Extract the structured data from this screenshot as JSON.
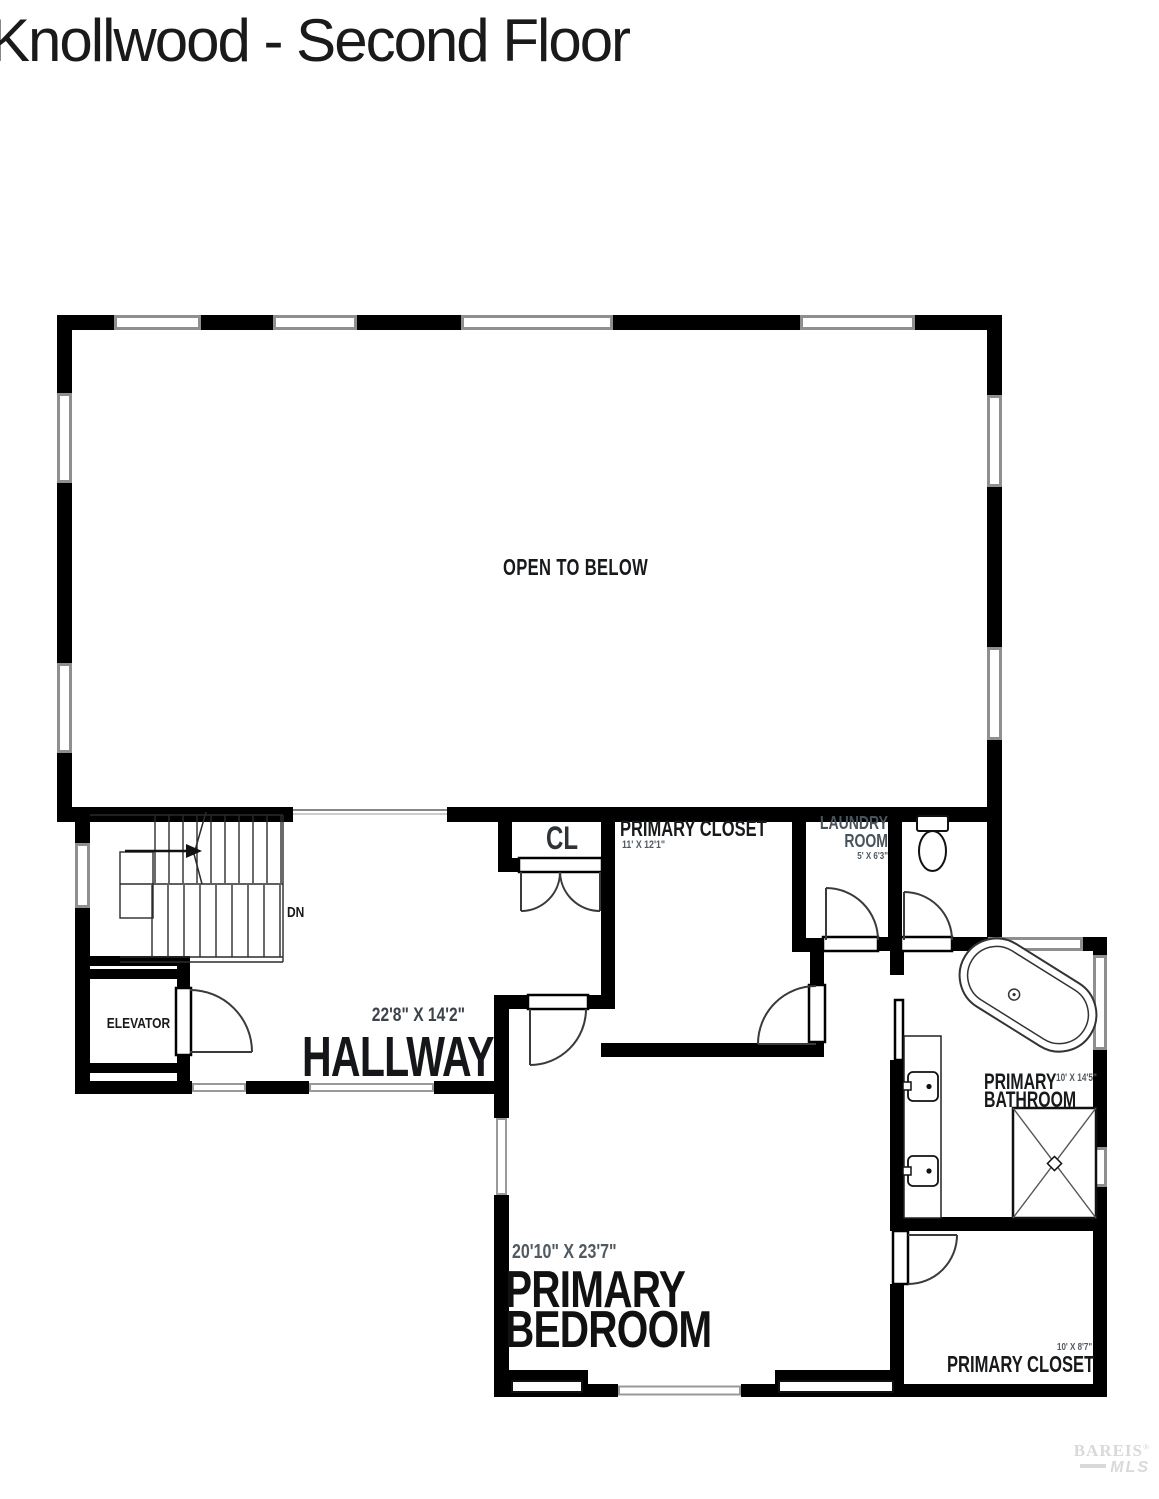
{
  "title": "Knollwood - Second Floor",
  "rooms": {
    "open_to_below": {
      "label": "OPEN TO BELOW"
    },
    "closet_cl": {
      "label": "CL"
    },
    "primary_closet_upper": {
      "label": "PRIMARY CLOSET",
      "dimensions": "11' X 12'1\""
    },
    "laundry": {
      "label_line1": "LAUNDRY",
      "label_line2": "ROOM",
      "dimensions": "5' X 6'3\""
    },
    "elevator": {
      "label": "ELEVATOR"
    },
    "hallway": {
      "label": "HALLWAY",
      "dimensions": "22'8\" X 14'2\""
    },
    "primary_bedroom": {
      "label_line1": "PRIMARY",
      "label_line2": "BEDROOM",
      "dimensions": "20'10\" X 23'7\""
    },
    "primary_bathroom": {
      "label_line1": "PRIMARY",
      "label_line2": "BATHROOM",
      "dimensions": "10' X 14'5\""
    },
    "primary_closet_lower": {
      "label": "PRIMARY CLOSET",
      "dimensions": "10' X 8'7\""
    }
  },
  "stairs": {
    "direction_label": "DN"
  },
  "watermark": {
    "line1": "BAREIS",
    "registered": "®",
    "line2": "MLS"
  },
  "colors": {
    "wall": "#000000",
    "window_frame": "#8f8f8f",
    "room_label": "#17191b",
    "dimension_label": "#525a61",
    "watermark": "#d9d9d9"
  }
}
